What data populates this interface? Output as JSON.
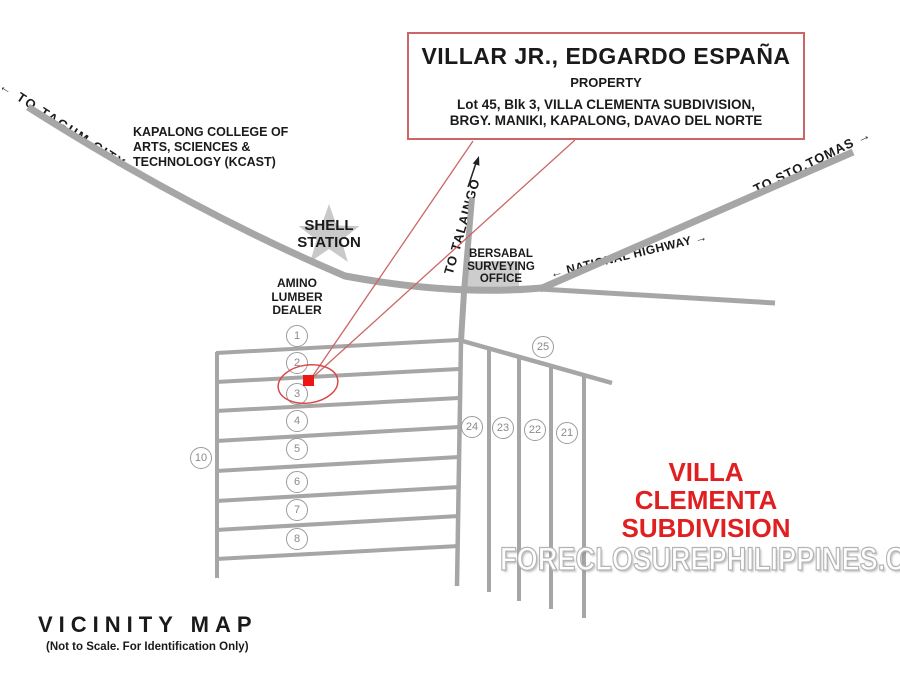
{
  "title_box": {
    "owner": "VILLAR JR., EDGARDO ESPAÑA",
    "type": "PROPERTY",
    "address_line1": "Lot 45, Blk 3, VILLA CLEMENTA SUBDIVISION,",
    "address_line2": "BRGY. MANIKI, KAPALONG, DAVAO DEL NORTE"
  },
  "map_labels": {
    "to_tagum_city": "←  TO TAGUM CITY",
    "kcast": "KAPALONG COLLEGE OF\nARTS, SCIENCES &\nTECHNOLOGY (KCAST)",
    "shell_station": "SHELL\nSTATION",
    "amino_lumber": "AMINO\nLUMBER\nDEALER",
    "bersabal_office": "BERSABAL\nSURVEYING\nOFFICE",
    "to_talaingo": "TO  TALAINGO",
    "national_highway": "← NATIONAL HIGHWAY →",
    "to_sto_tomas": "TO STO.TOMAS →",
    "subdivision_name": "VILLA CLEMENTA\nSUBDIVISION"
  },
  "block_numbers": [
    {
      "label": "1",
      "x": 297,
      "y": 336
    },
    {
      "label": "2",
      "x": 297,
      "y": 363
    },
    {
      "label": "3",
      "x": 297,
      "y": 394
    },
    {
      "label": "4",
      "x": 297,
      "y": 421
    },
    {
      "label": "5",
      "x": 297,
      "y": 449
    },
    {
      "label": "6",
      "x": 297,
      "y": 482
    },
    {
      "label": "7",
      "x": 297,
      "y": 510
    },
    {
      "label": "8",
      "x": 297,
      "y": 539
    },
    {
      "label": "10",
      "x": 201,
      "y": 458
    },
    {
      "label": "25",
      "x": 543,
      "y": 347
    },
    {
      "label": "24",
      "x": 472,
      "y": 427
    },
    {
      "label": "23",
      "x": 503,
      "y": 428
    },
    {
      "label": "22",
      "x": 535,
      "y": 430
    },
    {
      "label": "21",
      "x": 567,
      "y": 433
    }
  ],
  "legend": {
    "title": "VICINITY MAP",
    "subtitle": "(Not to Scale. For Identification Only)"
  },
  "watermark": "FORECLOSUREPHILIPPINES.COM",
  "colors": {
    "road": "#a6a6a6",
    "red_accent": "#e02020",
    "red_border": "#cc6666",
    "red_marker": "#ee1515",
    "circle_stroke": "#9b9b9b",
    "watermark_stroke": "#b4b4b4"
  }
}
